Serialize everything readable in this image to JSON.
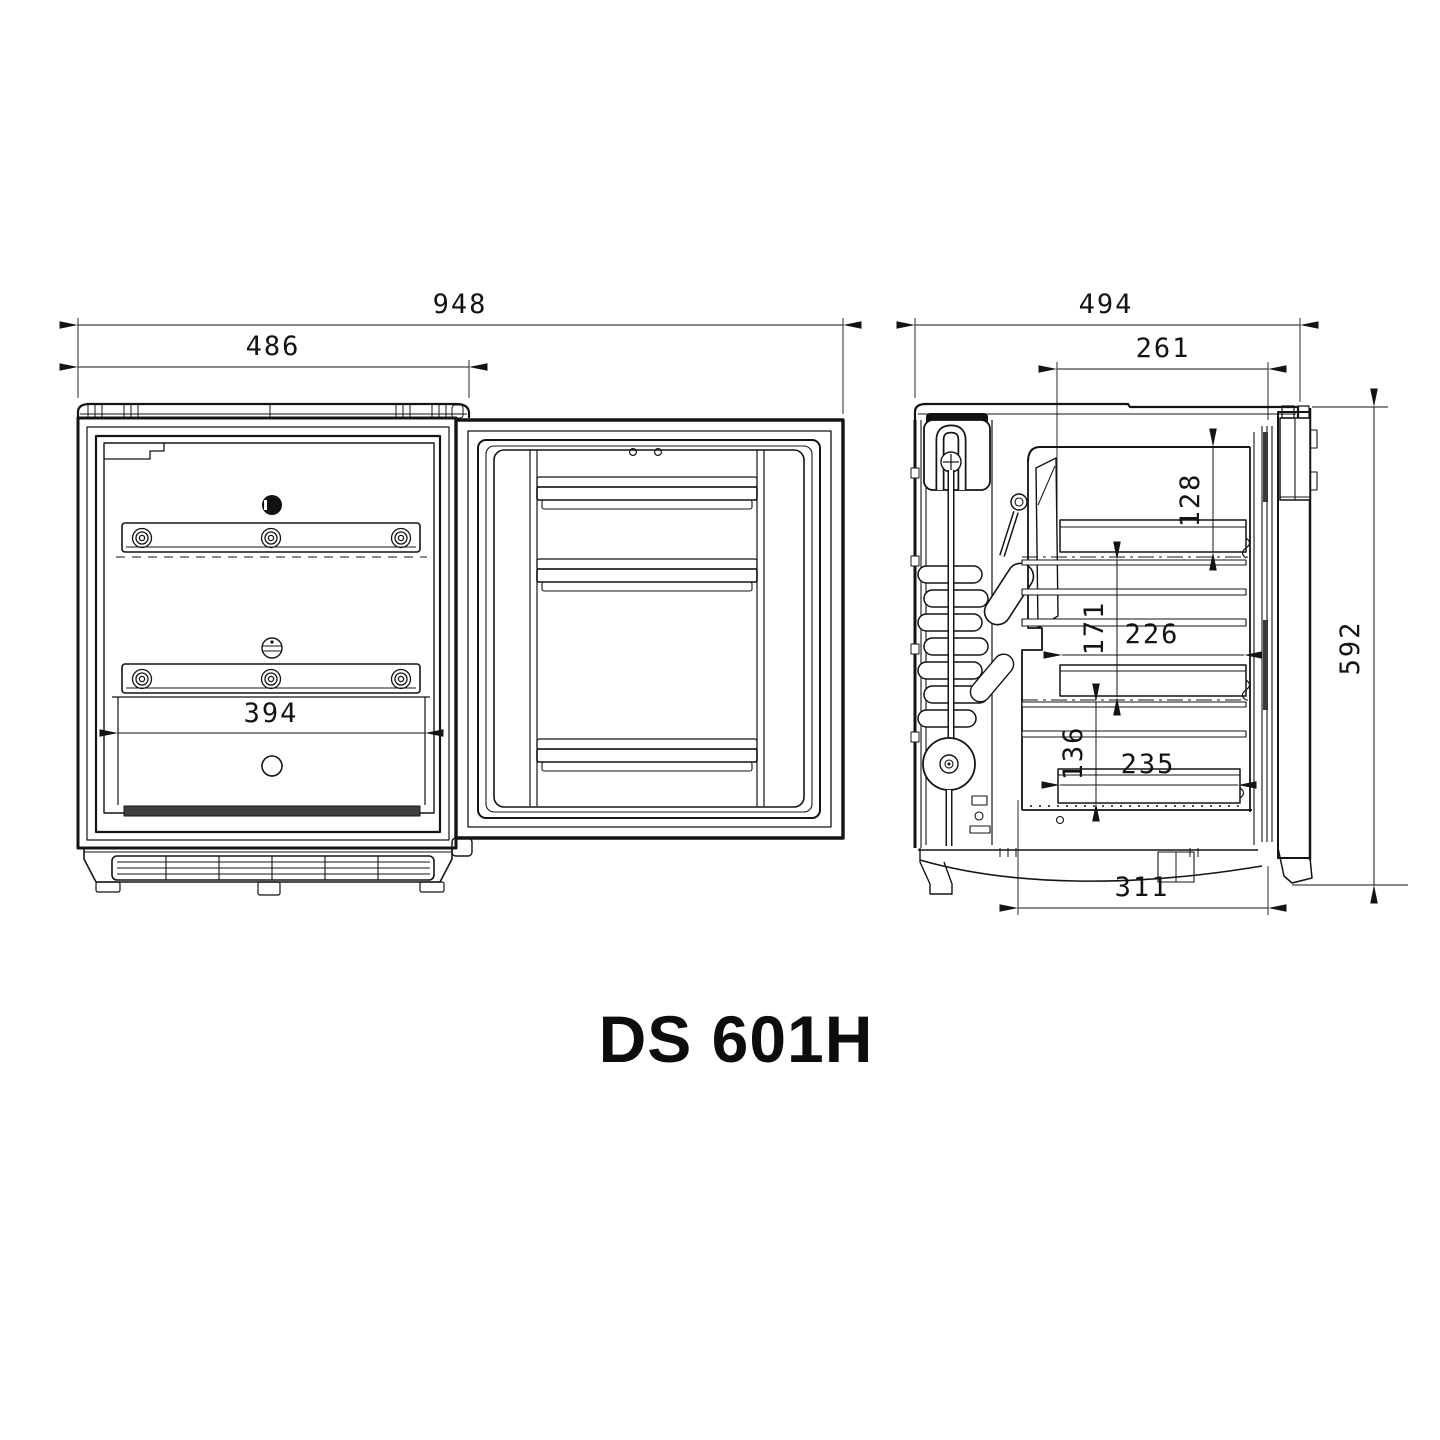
{
  "title": "DS 601H",
  "drawing_type": "technical-dimension-drawing",
  "line_color": "#141414",
  "background_color": "#ffffff",
  "front_view": {
    "name": "Front view, door open",
    "dims": {
      "total_width": "948",
      "cabinet_width": "486",
      "interior_width": "394"
    }
  },
  "side_view": {
    "name": "Side section view",
    "dims": {
      "total_depth": "494",
      "interior_depth": "261",
      "top_clearance": "128",
      "middle_clearance": "171",
      "shelf_depth": "226",
      "lower_clearance": "136",
      "lower_shelf_depth": "235",
      "base_depth": "311",
      "height": "592"
    }
  }
}
